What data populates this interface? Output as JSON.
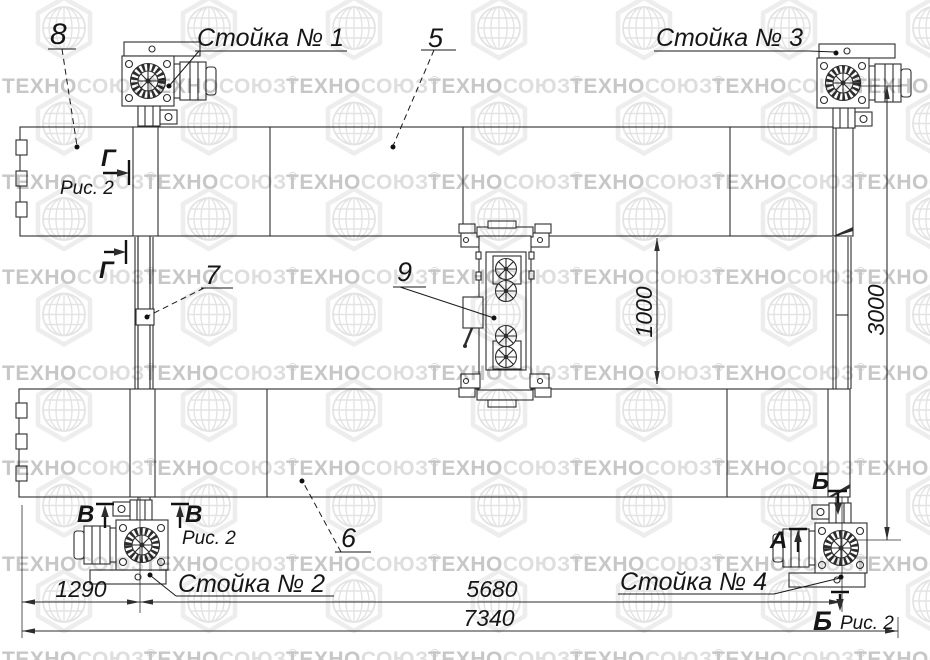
{
  "drawing": {
    "callouts": {
      "n5": "5",
      "n6": "6",
      "n7": "7",
      "n8": "8",
      "n9": "9"
    },
    "posts": {
      "post1": "Стойка № 1",
      "post2": "Стойка № 2",
      "post3": "Стойка № 3",
      "post4": "Стойка № 4"
    },
    "sections": {
      "gamma": "Г",
      "v": "В",
      "b": "Б",
      "a": "А"
    },
    "fig_ref": "Рис. 2",
    "dims": {
      "left_offset": "1290",
      "post_span": "5680",
      "total_length": "7340",
      "runway_gap": "1000",
      "width_span": "3000"
    }
  },
  "watermark": {
    "brand_part1": "ТЕХНО",
    "brand_part2": "СОЮЗ",
    "registered": "®"
  },
  "colors": {
    "line": "#2d2d2d",
    "label_text": "#161616",
    "watermark_dark": "#c7c7c7",
    "watermark_light": "#dedede",
    "watermark_globe": "#e3e3e3"
  }
}
